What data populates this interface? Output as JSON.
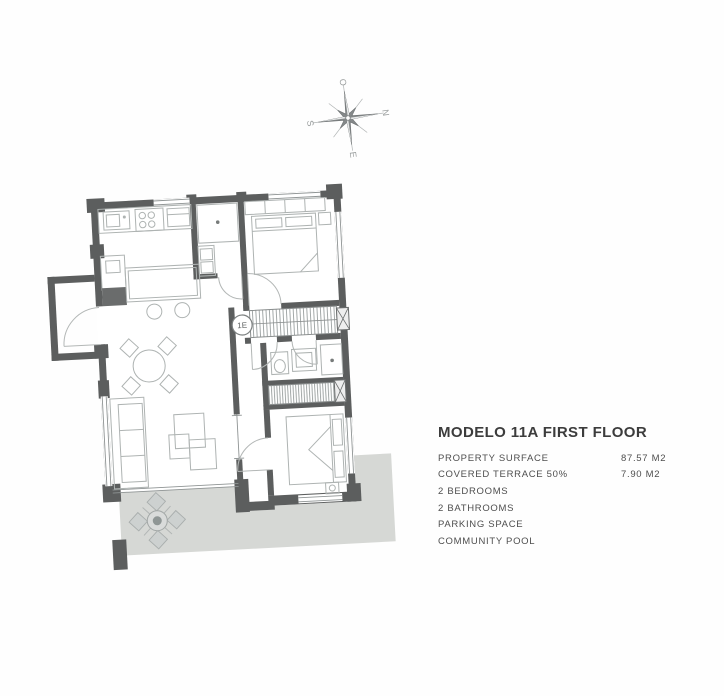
{
  "info_panel": {
    "title": "MODELO 11A FIRST FLOOR",
    "rows": [
      {
        "label": "PROPERTY SURFACE",
        "value": "87.57 M2"
      },
      {
        "label": "COVERED TERRACE 50%",
        "value": "7.90 M2"
      },
      {
        "label": "2 BEDROOMS",
        "value": ""
      },
      {
        "label": "2 BATHROOMS",
        "value": ""
      },
      {
        "label": "PARKING SPACE",
        "value": ""
      },
      {
        "label": "COMMUNITY POOL",
        "value": ""
      }
    ]
  },
  "floor_plan": {
    "stair_label": "1E",
    "compass": {
      "north": "N",
      "south": "S",
      "east": "E",
      "west": "O"
    },
    "colors": {
      "wall": "#5c5e5e",
      "furniture_line": "#aeb3b2",
      "terrace_fill": "#d6d8d5",
      "hatch_line": "#9aa0a0"
    }
  }
}
